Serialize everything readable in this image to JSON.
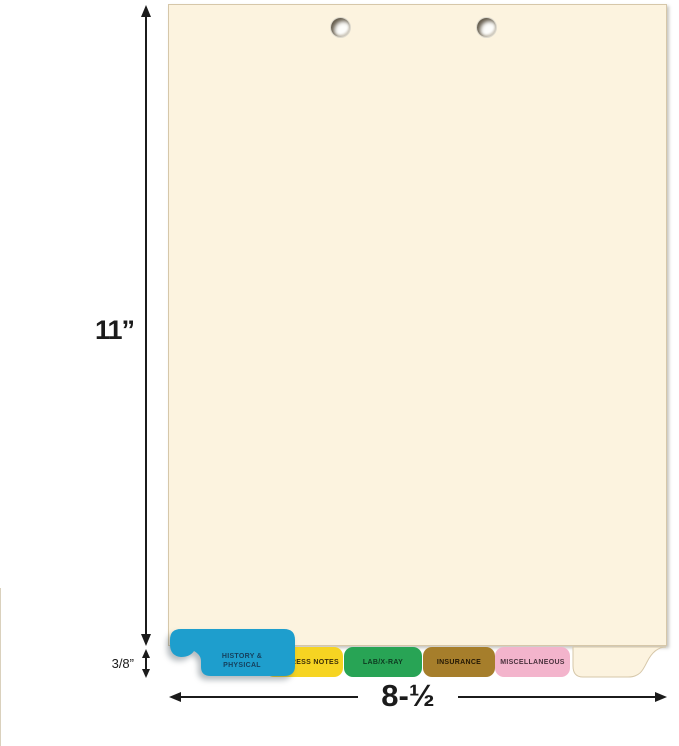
{
  "dimensions": {
    "sheet_height": "11”",
    "sheet_width": "8-½",
    "tab_extension": "3/8”"
  },
  "tabs": [
    {
      "id": "history-physical",
      "line1": "HISTORY &",
      "line2": "PHYSICAL",
      "bg": "#1E9ECD",
      "fg": "#153F5C"
    },
    {
      "id": "progress-notes",
      "label": "PROGRESS NOTES",
      "bg": "#F6D422",
      "fg": "#3A2D07"
    },
    {
      "id": "lab-xray",
      "label": "LAB/X-RAY",
      "bg": "#28A455",
      "fg": "#0D3A20"
    },
    {
      "id": "insurance",
      "label": "INSURANCE",
      "bg": "#A67E2B",
      "fg": "#231805"
    },
    {
      "id": "miscellaneous",
      "label": "MISCELLANEOUS",
      "bg": "#F3B4CC",
      "fg": "#4B323E"
    },
    {
      "id": "blank",
      "label": "",
      "bg": "#FCF3DF",
      "fg": "#000000"
    }
  ],
  "colors": {
    "sheet": "#FCF3DF",
    "sheet_border": "#D6C7A9",
    "dimension_ink": "#1B1B1B",
    "background": "#FFFFFF"
  }
}
